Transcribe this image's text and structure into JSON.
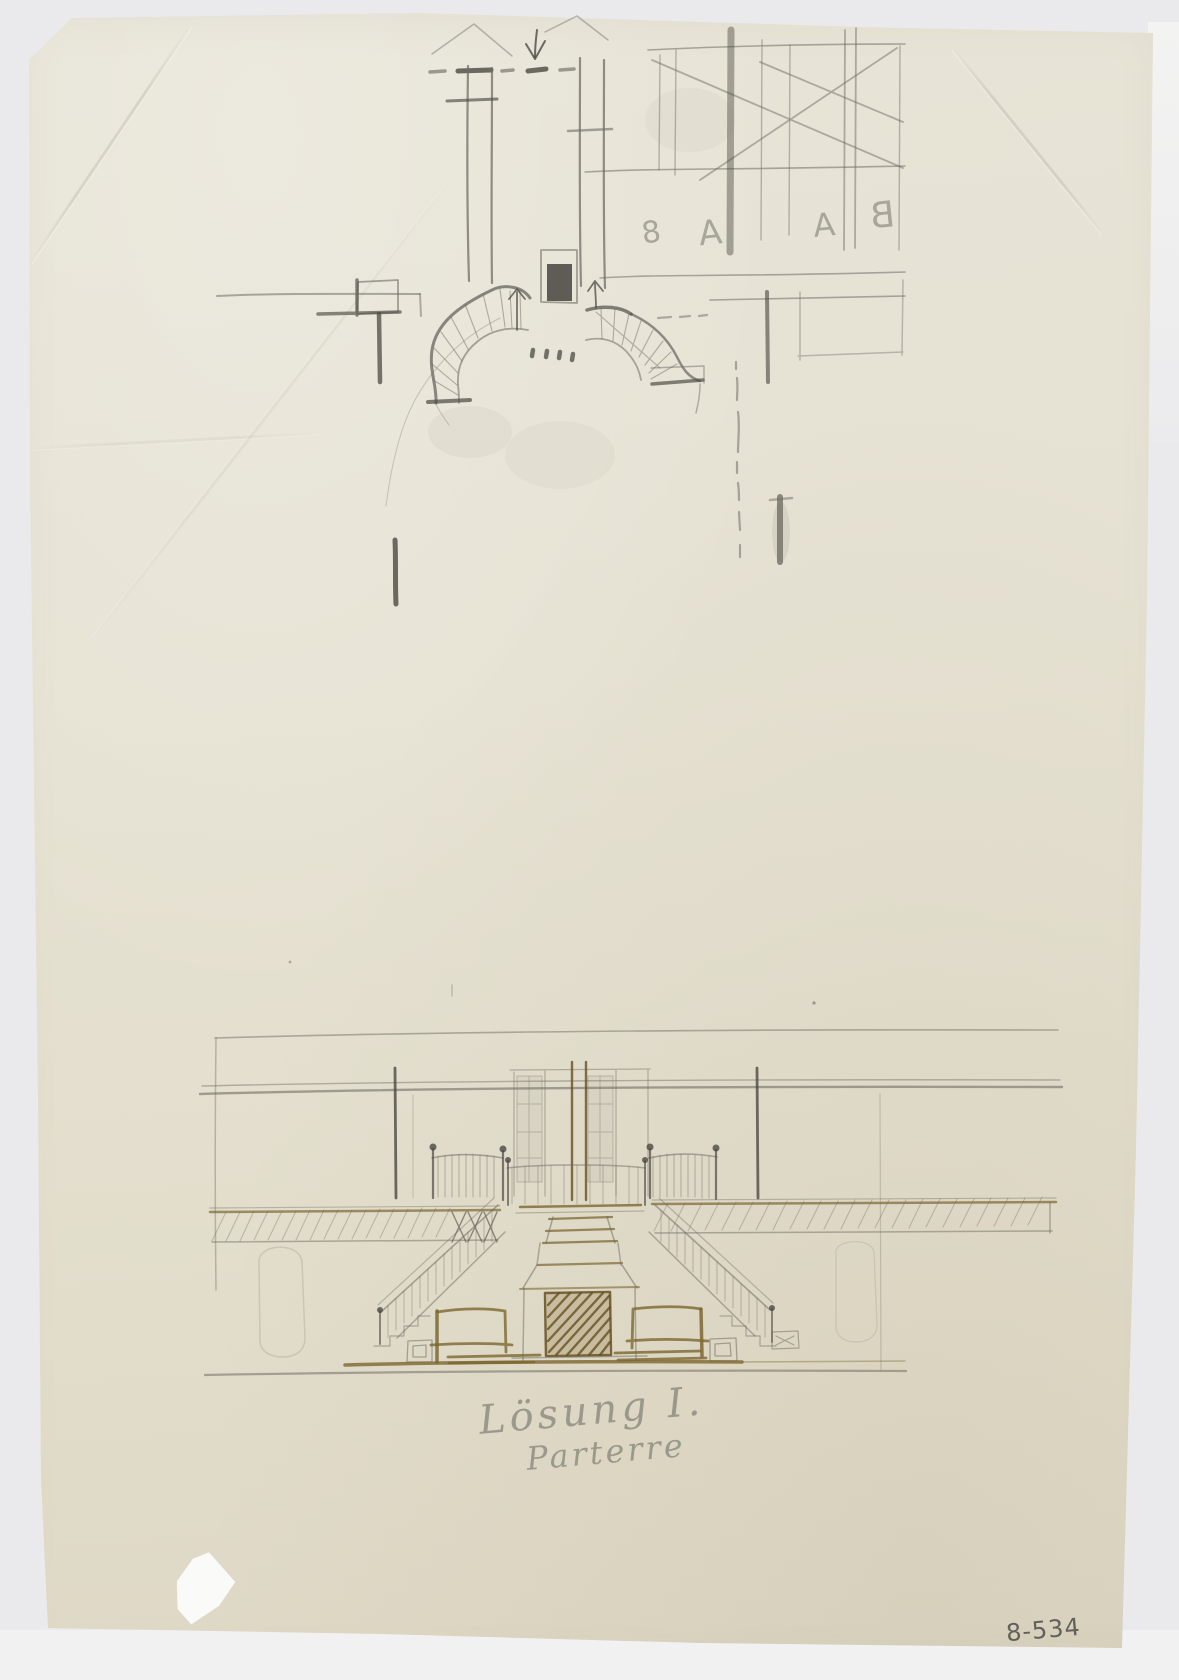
{
  "artifact": {
    "background_color": "#eaeaec",
    "paper_color": "#e6e2d3",
    "media_colors": {
      "graphite": "#6f6d65",
      "graphite_dark": "#4b4943",
      "ink_brown": "#7c6730",
      "ink_brown_dark": "#66501f",
      "pencil_caption": "#8b897f"
    }
  },
  "inscriptions": {
    "caption_line1": "Lösung I.",
    "caption_line2": "Parterre",
    "catalog_number": "8-534"
  },
  "plan_sketch": {
    "mirrored_letters": [
      "8",
      "A",
      "A",
      "B"
    ]
  }
}
